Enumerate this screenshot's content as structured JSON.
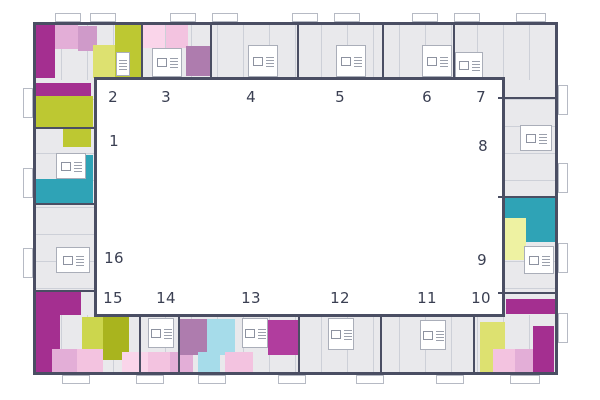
{
  "colors": {
    "wall": "#4a4e63",
    "room_fill": "#e9e9ec",
    "room_line": "#cdd0d8",
    "courtyard": "#ffffff",
    "M": "#a42f90",
    "M2": "#b13d9e",
    "PK1": "#fad5ea",
    "PK": "#f3c3e0",
    "PK2": "#e3aed7",
    "MV": "#cf9ac9",
    "MP": "#ae7cae",
    "OL": "#bdc832",
    "OLL": "#dde170",
    "OLL2": "#ccd64d",
    "OLD": "#a9b41e",
    "PY": "#eef2a2",
    "TE": "#2fa3b6",
    "CY": "#a6dcea",
    "label_text": "#3e4358",
    "number_text": "#3a3f52"
  },
  "legend": {
    "items": [
      {
        "label": "однокомнатные квартиры",
        "price": "от 2,6 до 4 млн. ₽",
        "price_color": "#9b2e89",
        "swatches": [
          "#fcdff0",
          "#f6cde7",
          "#efbadb",
          "#dfa6cf",
          "#bd92bd",
          "#c464ae",
          "#b1489e",
          "#9d3089"
        ]
      },
      {
        "label": "двухкомнатные квартиры",
        "price": "от 3,5 до 5,2 млн. ₽",
        "price_color": "#8a9a27",
        "swatches": [
          "#f4f6bf",
          "#dfe57f",
          "#c2cd1d",
          "#9aa83a",
          "#7f8d22"
        ]
      },
      {
        "label": "трехкомнатные квартиры",
        "price": "от 5,2 до 7,6 млн. ₽",
        "price_color": "#2aa3b8",
        "swatches": [
          "#cfeff6",
          "#aee2ee",
          "#93c8d6",
          "#45b2c4",
          "#2ba4b8"
        ]
      }
    ]
  },
  "sections": [
    {
      "label": "1",
      "x": 114,
      "y": 141
    },
    {
      "label": "2",
      "x": 113,
      "y": 97
    },
    {
      "label": "3",
      "x": 166,
      "y": 97
    },
    {
      "label": "4",
      "x": 251,
      "y": 97
    },
    {
      "label": "5",
      "x": 340,
      "y": 97
    },
    {
      "label": "6",
      "x": 427,
      "y": 97
    },
    {
      "label": "7",
      "x": 481,
      "y": 97
    },
    {
      "label": "8",
      "x": 483,
      "y": 146
    },
    {
      "label": "9",
      "x": 482,
      "y": 260
    },
    {
      "label": "10",
      "x": 481,
      "y": 298
    },
    {
      "label": "11",
      "x": 427,
      "y": 298
    },
    {
      "label": "12",
      "x": 340,
      "y": 298
    },
    {
      "label": "13",
      "x": 251,
      "y": 298
    },
    {
      "label": "14",
      "x": 166,
      "y": 298
    },
    {
      "label": "15",
      "x": 113,
      "y": 298
    },
    {
      "label": "16",
      "x": 114,
      "y": 258
    }
  ],
  "floor_plan": {
    "outer": {
      "x": 33,
      "y": 22,
      "w": 525,
      "h": 353
    },
    "courtyard": {
      "x": 94,
      "y": 77,
      "w": 411,
      "h": 240
    },
    "bands": [
      {
        "x": 36,
        "y": 25,
        "w": 519,
        "h": 55,
        "dir": "h"
      },
      {
        "x": 36,
        "y": 315,
        "w": 519,
        "h": 57,
        "dir": "h"
      },
      {
        "x": 36,
        "y": 80,
        "w": 60,
        "h": 235,
        "dir": "v"
      },
      {
        "x": 498,
        "y": 80,
        "w": 57,
        "h": 235,
        "dir": "v"
      }
    ],
    "blocks": [
      [
        36,
        25,
        19,
        53,
        "M"
      ],
      [
        55,
        25,
        23,
        24,
        "PK2"
      ],
      [
        78,
        26,
        19,
        25,
        "MV"
      ],
      [
        93,
        45,
        26,
        33,
        "OLL"
      ],
      [
        115,
        25,
        26,
        53,
        "OL"
      ],
      [
        143,
        25,
        22,
        23,
        "PK1"
      ],
      [
        166,
        25,
        22,
        23,
        "PK"
      ],
      [
        186,
        46,
        24,
        30,
        "MP"
      ],
      [
        36,
        83,
        55,
        13,
        "M"
      ],
      [
        36,
        96,
        57,
        31,
        "OL"
      ],
      [
        63,
        127,
        28,
        20,
        "OL"
      ],
      [
        75,
        155,
        18,
        24,
        "TE"
      ],
      [
        36,
        179,
        57,
        24,
        "TE"
      ],
      [
        36,
        292,
        45,
        23,
        "M"
      ],
      [
        36,
        315,
        24,
        57,
        "M"
      ],
      [
        52,
        349,
        25,
        23,
        "PK2"
      ],
      [
        77,
        349,
        26,
        23,
        "PK"
      ],
      [
        82,
        317,
        21,
        32,
        "OLL2"
      ],
      [
        103,
        317,
        26,
        43,
        "OLD"
      ],
      [
        122,
        352,
        26,
        20,
        "PK1"
      ],
      [
        148,
        352,
        22,
        20,
        "PK"
      ],
      [
        170,
        352,
        23,
        20,
        "PK2"
      ],
      [
        180,
        319,
        27,
        36,
        "MP"
      ],
      [
        207,
        319,
        28,
        36,
        "CY"
      ],
      [
        198,
        352,
        22,
        20,
        "CY"
      ],
      [
        225,
        352,
        28,
        20,
        "PK"
      ],
      [
        268,
        320,
        30,
        35,
        "M2"
      ],
      [
        480,
        322,
        25,
        50,
        "OLL"
      ],
      [
        493,
        349,
        22,
        23,
        "PK"
      ],
      [
        515,
        349,
        22,
        23,
        "PK2"
      ],
      [
        533,
        326,
        21,
        46,
        "M"
      ],
      [
        506,
        299,
        49,
        15,
        "M"
      ],
      [
        504,
        198,
        51,
        20,
        "TE"
      ],
      [
        525,
        198,
        30,
        44,
        "TE"
      ],
      [
        504,
        218,
        22,
        42,
        "PY"
      ]
    ],
    "cores": [
      [
        116,
        52,
        14,
        24
      ],
      [
        152,
        48,
        30,
        29
      ],
      [
        248,
        45,
        30,
        32
      ],
      [
        336,
        45,
        30,
        32
      ],
      [
        422,
        45,
        30,
        32
      ],
      [
        455,
        52,
        28,
        26
      ],
      [
        56,
        153,
        30,
        26
      ],
      [
        56,
        247,
        34,
        26
      ],
      [
        520,
        125,
        32,
        26
      ],
      [
        524,
        246,
        30,
        28
      ],
      [
        148,
        318,
        26,
        30
      ],
      [
        242,
        318,
        26,
        30
      ],
      [
        328,
        318,
        26,
        32
      ],
      [
        420,
        320,
        26,
        30
      ]
    ],
    "walls": [
      [
        141,
        25,
        2,
        55
      ],
      [
        210,
        25,
        2,
        55
      ],
      [
        297,
        25,
        2,
        55
      ],
      [
        382,
        25,
        2,
        55
      ],
      [
        453,
        25,
        2,
        55
      ],
      [
        139,
        315,
        2,
        57
      ],
      [
        178,
        315,
        2,
        57
      ],
      [
        298,
        315,
        2,
        57
      ],
      [
        380,
        315,
        2,
        57
      ],
      [
        473,
        315,
        2,
        57
      ],
      [
        36,
        127,
        60,
        2
      ],
      [
        36,
        203,
        60,
        2
      ],
      [
        36,
        290,
        60,
        2
      ],
      [
        498,
        97,
        57,
        2
      ],
      [
        498,
        196,
        57,
        2
      ],
      [
        498,
        292,
        57,
        2
      ]
    ],
    "balconies": [
      [
        55,
        13,
        26,
        9
      ],
      [
        90,
        13,
        26,
        9
      ],
      [
        170,
        13,
        26,
        9
      ],
      [
        212,
        13,
        26,
        9
      ],
      [
        292,
        13,
        26,
        9
      ],
      [
        334,
        13,
        26,
        9
      ],
      [
        412,
        13,
        26,
        9
      ],
      [
        454,
        13,
        26,
        9
      ],
      [
        516,
        13,
        30,
        9
      ],
      [
        62,
        375,
        28,
        9
      ],
      [
        136,
        375,
        28,
        9
      ],
      [
        198,
        375,
        28,
        9
      ],
      [
        278,
        375,
        28,
        9
      ],
      [
        356,
        375,
        28,
        9
      ],
      [
        436,
        375,
        28,
        9
      ],
      [
        510,
        375,
        30,
        9
      ],
      [
        23,
        88,
        10,
        30
      ],
      [
        23,
        168,
        10,
        30
      ],
      [
        23,
        248,
        10,
        30
      ],
      [
        558,
        85,
        10,
        30
      ],
      [
        558,
        163,
        10,
        30
      ],
      [
        558,
        243,
        10,
        30
      ],
      [
        558,
        313,
        10,
        30
      ]
    ],
    "legend_rows": [
      {
        "x": 130,
        "y": 137,
        "sw": "sw"
      },
      {
        "x": 183,
        "y": 188,
        "sw": "sw17"
      },
      {
        "x": 183,
        "y": 240,
        "sw": "sw17"
      }
    ]
  }
}
